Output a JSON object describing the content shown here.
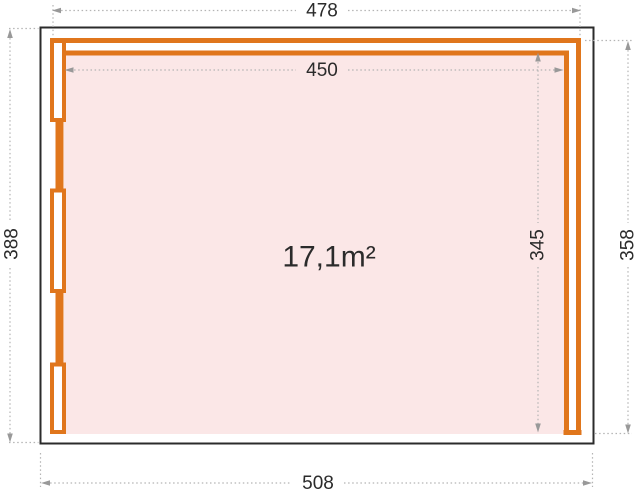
{
  "drawing": {
    "area_label": "17,1m²",
    "dim_top_outer": "478",
    "dim_top_inner": "450",
    "dim_bottom": "508",
    "dim_left": "388",
    "dim_right_outer": "358",
    "dim_right_inner": "345"
  },
  "colors": {
    "wall-orange": "#e0761c",
    "floor-pink": "#fbe7e7",
    "outline-dark": "#2b2b2b",
    "dim-line-gray": "#b4b4b4",
    "arrow-gray": "#999999",
    "text-dark": "#2b2b2b"
  }
}
